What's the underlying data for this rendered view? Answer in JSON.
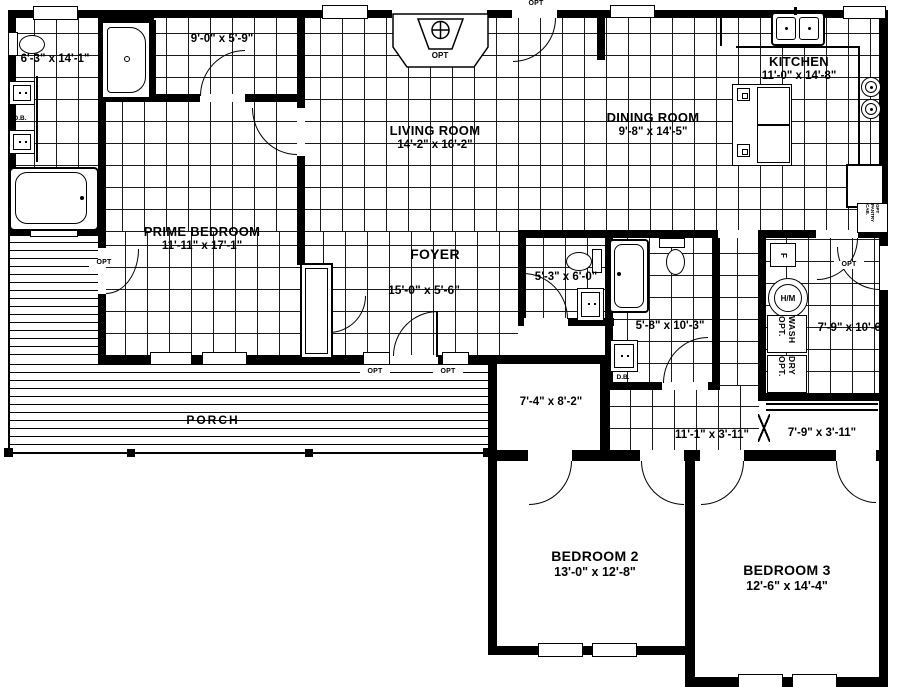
{
  "rooms": {
    "prime_bath": {
      "dims": "6'-3\" x 14'-1\""
    },
    "walkin_closet": {
      "dims": "9'-0\" x 5'-9\""
    },
    "prime_bedroom": {
      "name": "PRIME BEDROOM",
      "dims": "11'-11\" x 17'-1\""
    },
    "living": {
      "name": "LIVING ROOM",
      "dims": "14'-2\" x 16'-2\""
    },
    "dining": {
      "name": "DINING ROOM",
      "dims": "9'-8\" x 14'-5\""
    },
    "kitchen": {
      "name": "KITCHEN",
      "dims": "11'-0\" x 14'-8\""
    },
    "foyer": {
      "name": "FOYER",
      "dims": "15'-0\" x 5'-6\""
    },
    "half_bath": {
      "dims": "5'-3\" x 6'-0\""
    },
    "full_bath": {
      "dims": "5'-8\" x 10'-3\""
    },
    "utility": {
      "dims": "7'-9\" x 10'-6\""
    },
    "flex": {
      "dims": "7'-4\" x 8'-2\""
    },
    "hall": {
      "dims": "11'-1\" x 3'-11\""
    },
    "hall_closet": {
      "dims": "7'-9\" x 3'-11\""
    },
    "bedroom2": {
      "name": "BEDROOM 2",
      "dims": "13'-0\" x 12'-8\""
    },
    "bedroom3": {
      "name": "BEDROOM 3",
      "dims": "12'-6\" x 14'-4\""
    },
    "porch": {
      "name": "PORCH"
    }
  },
  "labels": {
    "opt": "OPT",
    "db": "D.B.",
    "wash": "WASH OPT.",
    "dry": "DRY OPT.",
    "hm": "H/M",
    "furnace": "F",
    "pantry": "OPT PANTRY CAB."
  },
  "colors": {
    "ink": "#000000",
    "paper": "#ffffff"
  }
}
